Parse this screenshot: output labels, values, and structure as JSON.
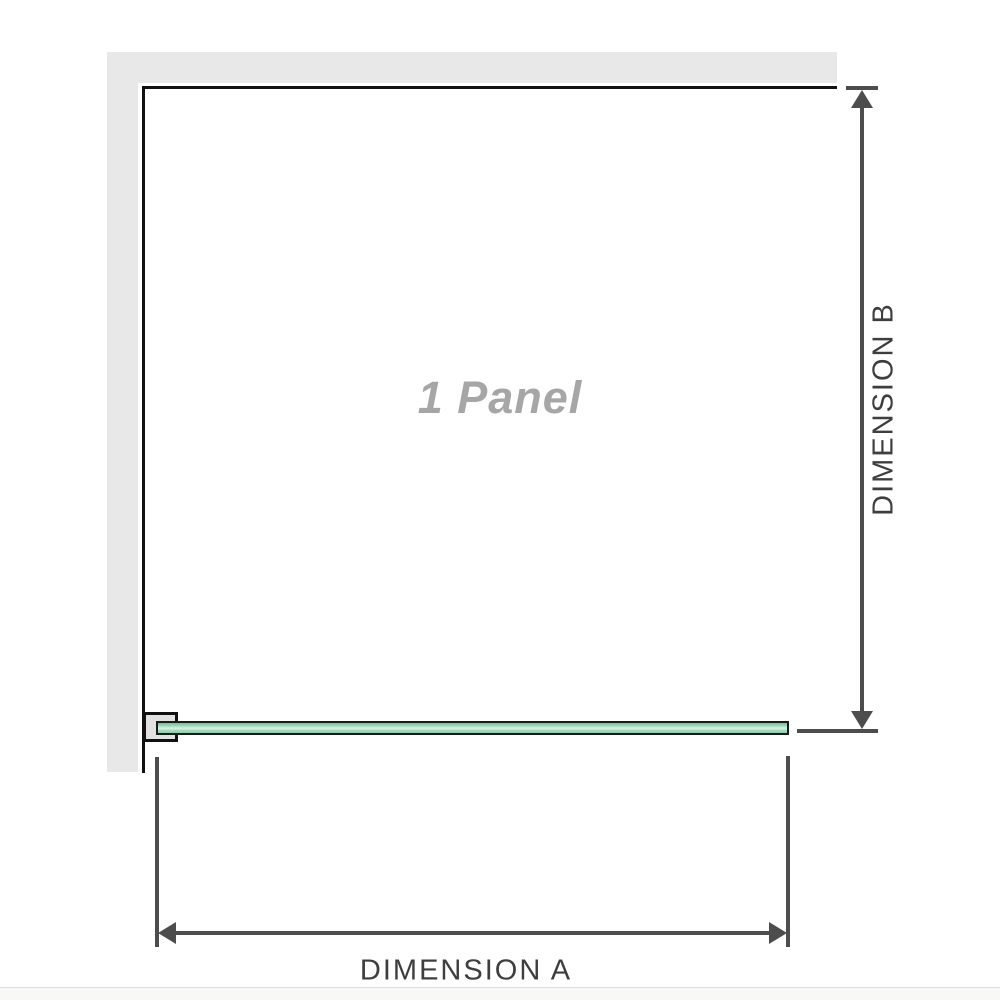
{
  "diagram": {
    "panel_label": "1 Panel",
    "dimension_a_label": "DIMENSION A",
    "dimension_b_label": "DIMENSION B",
    "colors": {
      "wall": "#e8e8e8",
      "edge_line": "#111111",
      "dimension_line": "#4d4d4d",
      "dimension_text": "#3e3e3e",
      "panel_label_text": "#a6a6a6",
      "glass_green": "#8bcea8",
      "glass_highlight": "#ddf1e6",
      "bracket_fill": "#e2e2e2"
    }
  }
}
